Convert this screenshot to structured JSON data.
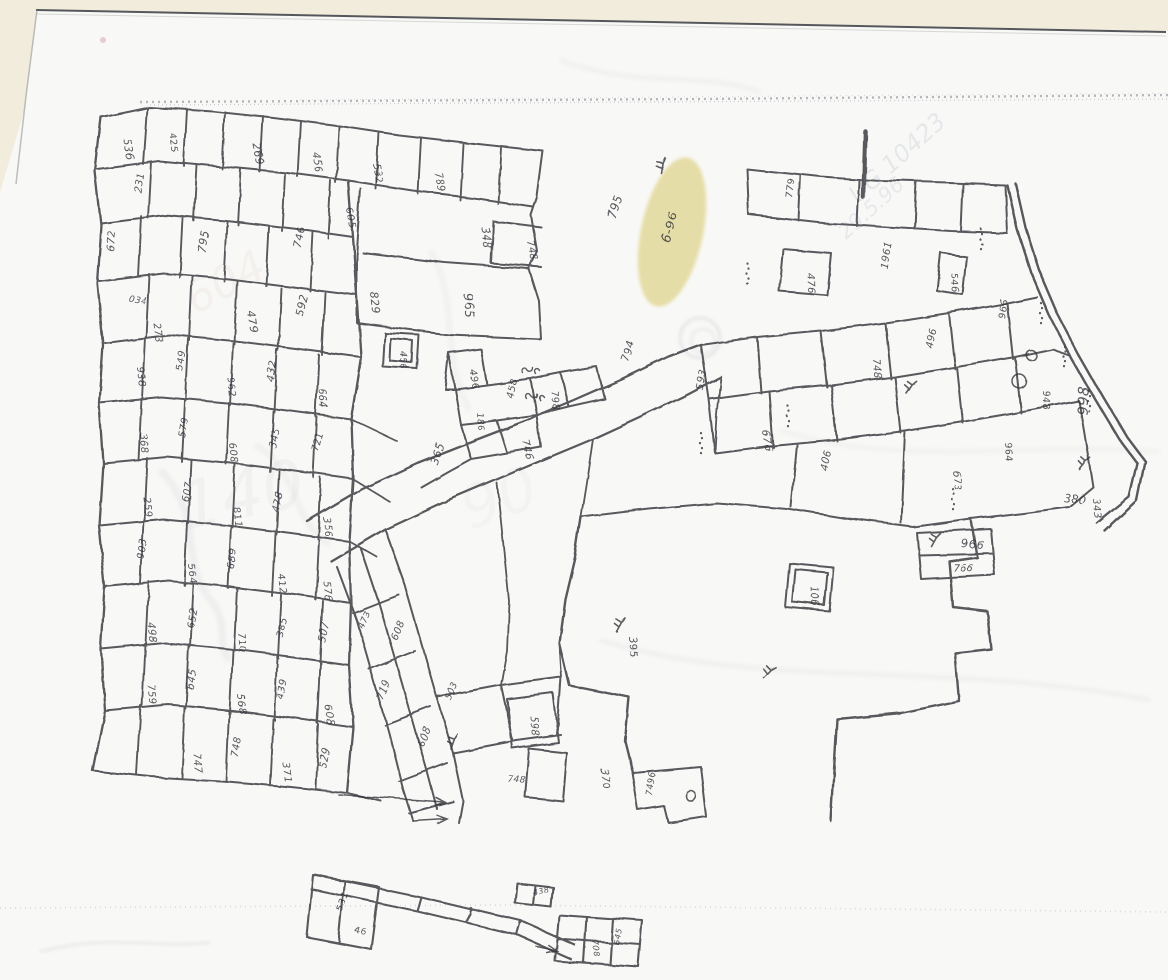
{
  "document": {
    "kind": "scanned hand-drawn cadastral plot map",
    "numerals_script_note": "parcel numbers appear handwritten in Bengali-style numerals; transliterated readings stored in label text"
  },
  "theme": {
    "page_background": "#f2ecdc",
    "paper": "#f8f8f6",
    "ink": "#35353a",
    "faint_pencil": "#98a0ac",
    "crease": "#6f7680",
    "edge_line": "#55575a",
    "bleed_ink": "#7b87a8",
    "highlight": "#e9df9e",
    "pink_dot": "#d8a8b8"
  },
  "highlight": {
    "label": "6-96",
    "x": 672,
    "y": 232,
    "rx": 31,
    "ry": 76,
    "rot": 12,
    "color": "#e9df9e",
    "label_rot": -74,
    "label_size": 13
  },
  "labels": [
    [
      "536",
      122,
      138,
      80,
      11
    ],
    [
      "425",
      168,
      132,
      82,
      10
    ],
    [
      "231",
      140,
      192,
      -82,
      10
    ],
    [
      "269",
      252,
      143,
      80,
      11
    ],
    [
      "456",
      312,
      152,
      82,
      10
    ],
    [
      "532",
      372,
      163,
      80,
      10
    ],
    [
      "789",
      434,
      172,
      78,
      10
    ],
    [
      "605",
      346,
      208,
      82,
      10
    ],
    [
      "746",
      300,
      248,
      -78,
      11
    ],
    [
      "795",
      205,
      253,
      -80,
      11
    ],
    [
      "829",
      370,
      292,
      84,
      11
    ],
    [
      "672",
      112,
      250,
      -84,
      10
    ],
    [
      "479",
      246,
      310,
      82,
      11
    ],
    [
      "592",
      302,
      316,
      -78,
      11
    ],
    [
      "273",
      152,
      322,
      82,
      10
    ],
    [
      "034",
      127,
      300,
      10,
      9
    ],
    [
      "348",
      480,
      226,
      82,
      11
    ],
    [
      "748",
      526,
      240,
      78,
      10
    ],
    [
      "965",
      462,
      292,
      84,
      13
    ],
    [
      "456",
      400,
      351,
      88,
      9
    ],
    [
      "496",
      468,
      368,
      82,
      10
    ],
    [
      "458",
      512,
      398,
      -78,
      10
    ],
    [
      "798",
      550,
      390,
      82,
      10
    ],
    [
      "746",
      522,
      440,
      78,
      10
    ],
    [
      "365",
      436,
      464,
      -72,
      11
    ],
    [
      "186",
      476,
      412,
      85,
      9
    ],
    [
      "795",
      614,
      218,
      -74,
      12
    ],
    [
      "794",
      628,
      362,
      -76,
      11
    ],
    [
      "593",
      702,
      390,
      -78,
      10
    ],
    [
      "779",
      792,
      198,
      -84,
      10
    ],
    [
      "476",
      806,
      272,
      88,
      10
    ],
    [
      "546",
      950,
      272,
      86,
      10
    ],
    [
      "1961",
      886,
      268,
      -80,
      10
    ],
    [
      "966",
      1004,
      318,
      -84,
      10
    ],
    [
      "948",
      1042,
      390,
      86,
      10
    ],
    [
      "998",
      1086,
      414,
      -86,
      14
    ],
    [
      "964",
      1004,
      442,
      84,
      10
    ],
    [
      "380",
      1062,
      500,
      8,
      11
    ],
    [
      "343",
      1092,
      498,
      84,
      10
    ],
    [
      "748",
      872,
      358,
      84,
      10
    ],
    [
      "496",
      932,
      348,
      -80,
      10
    ],
    [
      "676",
      762,
      430,
      84,
      10
    ],
    [
      "406",
      826,
      470,
      -78,
      10
    ],
    [
      "673",
      952,
      470,
      84,
      10
    ],
    [
      "966",
      960,
      546,
      4,
      11
    ],
    [
      "766",
      952,
      570,
      2,
      10
    ],
    [
      "106",
      810,
      586,
      84,
      10
    ],
    [
      "395",
      628,
      636,
      84,
      11
    ],
    [
      "7496",
      652,
      796,
      -84,
      9
    ],
    [
      "598",
      530,
      716,
      84,
      10
    ],
    [
      "748",
      506,
      780,
      6,
      9
    ],
    [
      "370",
      600,
      768,
      84,
      10
    ],
    [
      "608",
      396,
      640,
      -68,
      10
    ],
    [
      "719",
      382,
      700,
      -68,
      10
    ],
    [
      "608",
      422,
      746,
      -68,
      10
    ],
    [
      "503",
      450,
      700,
      -68,
      9
    ],
    [
      "473",
      362,
      628,
      -68,
      9
    ],
    [
      "938",
      136,
      366,
      84,
      10
    ],
    [
      "549",
      182,
      371,
      -80,
      10
    ],
    [
      "962",
      226,
      376,
      84,
      10
    ],
    [
      "432",
      272,
      381,
      -78,
      10
    ],
    [
      "664",
      318,
      388,
      84,
      10
    ],
    [
      "368",
      138,
      432,
      84,
      10
    ],
    [
      "579",
      184,
      437,
      -80,
      10
    ],
    [
      "608",
      228,
      442,
      84,
      10
    ],
    [
      "345",
      274,
      447,
      -78,
      10
    ],
    [
      "721",
      318,
      452,
      -78,
      10
    ],
    [
      "259",
      142,
      496,
      84,
      10
    ],
    [
      "607",
      187,
      501,
      -80,
      10
    ],
    [
      "811",
      232,
      506,
      84,
      10
    ],
    [
      "478",
      277,
      511,
      -78,
      10
    ],
    [
      "356",
      322,
      516,
      84,
      10
    ],
    [
      "903",
      142,
      558,
      -80,
      10
    ],
    [
      "564",
      187,
      563,
      84,
      10
    ],
    [
      "689",
      232,
      568,
      -80,
      10
    ],
    [
      "412",
      277,
      573,
      84,
      10
    ],
    [
      "576",
      322,
      580,
      84,
      10
    ],
    [
      "498",
      147,
      622,
      84,
      10
    ],
    [
      "652",
      192,
      627,
      -80,
      10
    ],
    [
      "710",
      237,
      632,
      84,
      10
    ],
    [
      "385",
      282,
      637,
      -78,
      10
    ],
    [
      "507",
      324,
      642,
      -78,
      10
    ],
    [
      "759",
      147,
      684,
      84,
      10
    ],
    [
      "645",
      192,
      689,
      -80,
      10
    ],
    [
      "568",
      237,
      694,
      84,
      10
    ],
    [
      "439",
      282,
      699,
      -78,
      10
    ],
    [
      "608",
      324,
      704,
      84,
      10
    ],
    [
      "747",
      192,
      752,
      84,
      10
    ],
    [
      "748",
      237,
      757,
      -80,
      10
    ],
    [
      "371",
      282,
      762,
      84,
      10
    ],
    [
      "529",
      324,
      767,
      -78,
      10
    ],
    [
      "531",
      342,
      912,
      -72,
      10
    ],
    [
      "46",
      354,
      932,
      6,
      8
    ],
    [
      "708",
      592,
      940,
      84,
      8
    ],
    [
      "645",
      618,
      944,
      -80,
      8
    ],
    [
      "438",
      532,
      894,
      -12,
      8
    ]
  ],
  "symbols": {
    "trees": [
      [
        660,
        172,
        -20
      ],
      [
        615,
        630,
        0
      ],
      [
        762,
        676,
        15
      ],
      [
        450,
        748,
        -10
      ],
      [
        905,
        392,
        5
      ],
      [
        1078,
        468,
        10
      ],
      [
        930,
        545,
        0
      ]
    ],
    "curls": [
      [
        522,
        372
      ],
      [
        526,
        398
      ]
    ],
    "dotcols": [
      [
        746,
        262
      ],
      [
        980,
        228
      ],
      [
        1040,
        302
      ],
      [
        1064,
        346
      ],
      [
        1088,
        390
      ],
      [
        786,
        404
      ],
      [
        700,
        432
      ],
      [
        952,
        488
      ]
    ],
    "ponds": [
      [
        1030,
        354,
        5
      ],
      [
        1018,
        380,
        7
      ],
      [
        690,
        795,
        5
      ]
    ]
  },
  "arrows": [
    [
      338,
      794,
      444,
      801
    ],
    [
      412,
      820,
      446,
      818
    ],
    [
      536,
      946,
      556,
      950
    ]
  ],
  "ghost_texts": [
    [
      "UG 10423",
      858,
      204,
      -42,
      24,
      0.15,
      "#7b87a8"
    ],
    [
      "29.5.96",
      846,
      240,
      -42,
      21,
      0.13,
      "#7b87a8"
    ],
    [
      "604",
      195,
      315,
      -28,
      44,
      0.07,
      "#b08c92"
    ],
    [
      "140",
      185,
      530,
      -12,
      66,
      0.07,
      "#9aa0ac"
    ],
    [
      "90",
      470,
      530,
      -20,
      60,
      0.05,
      "#9aa0ac"
    ]
  ]
}
